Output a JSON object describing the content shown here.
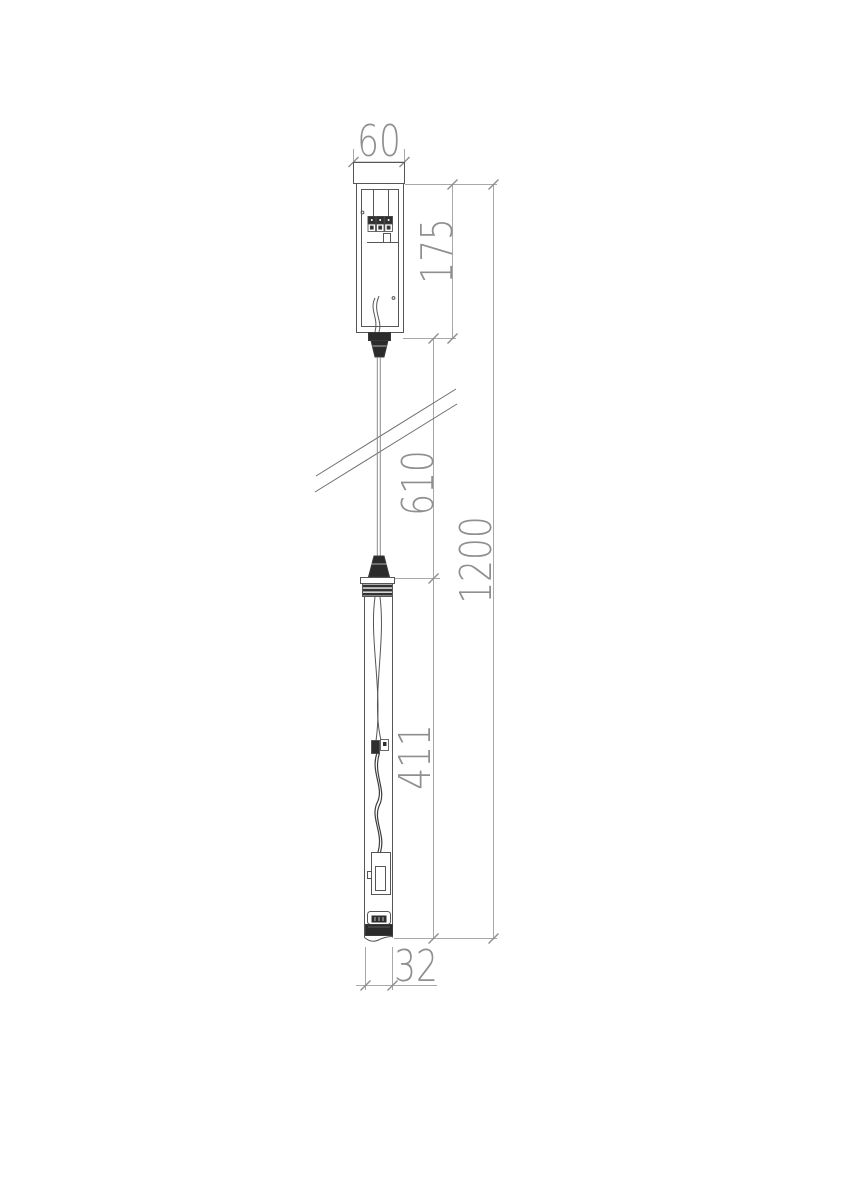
{
  "drawing": {
    "type": "technical-drawing",
    "subject": "pendant-lamp-suspension-fixture",
    "units_implied": "mm",
    "dimensions": {
      "canopy_width": "60",
      "canopy_height": "175",
      "suspension_length": "610",
      "overall_height": "1200",
      "lamp_body_length": "411",
      "lamp_diameter": "32"
    },
    "colors": {
      "background": "#ffffff",
      "outline": "#565656",
      "dimension_line": "#a8a8a8",
      "dimension_text": "#8f8f8f",
      "dark_fill": "#2b2b2b"
    }
  }
}
